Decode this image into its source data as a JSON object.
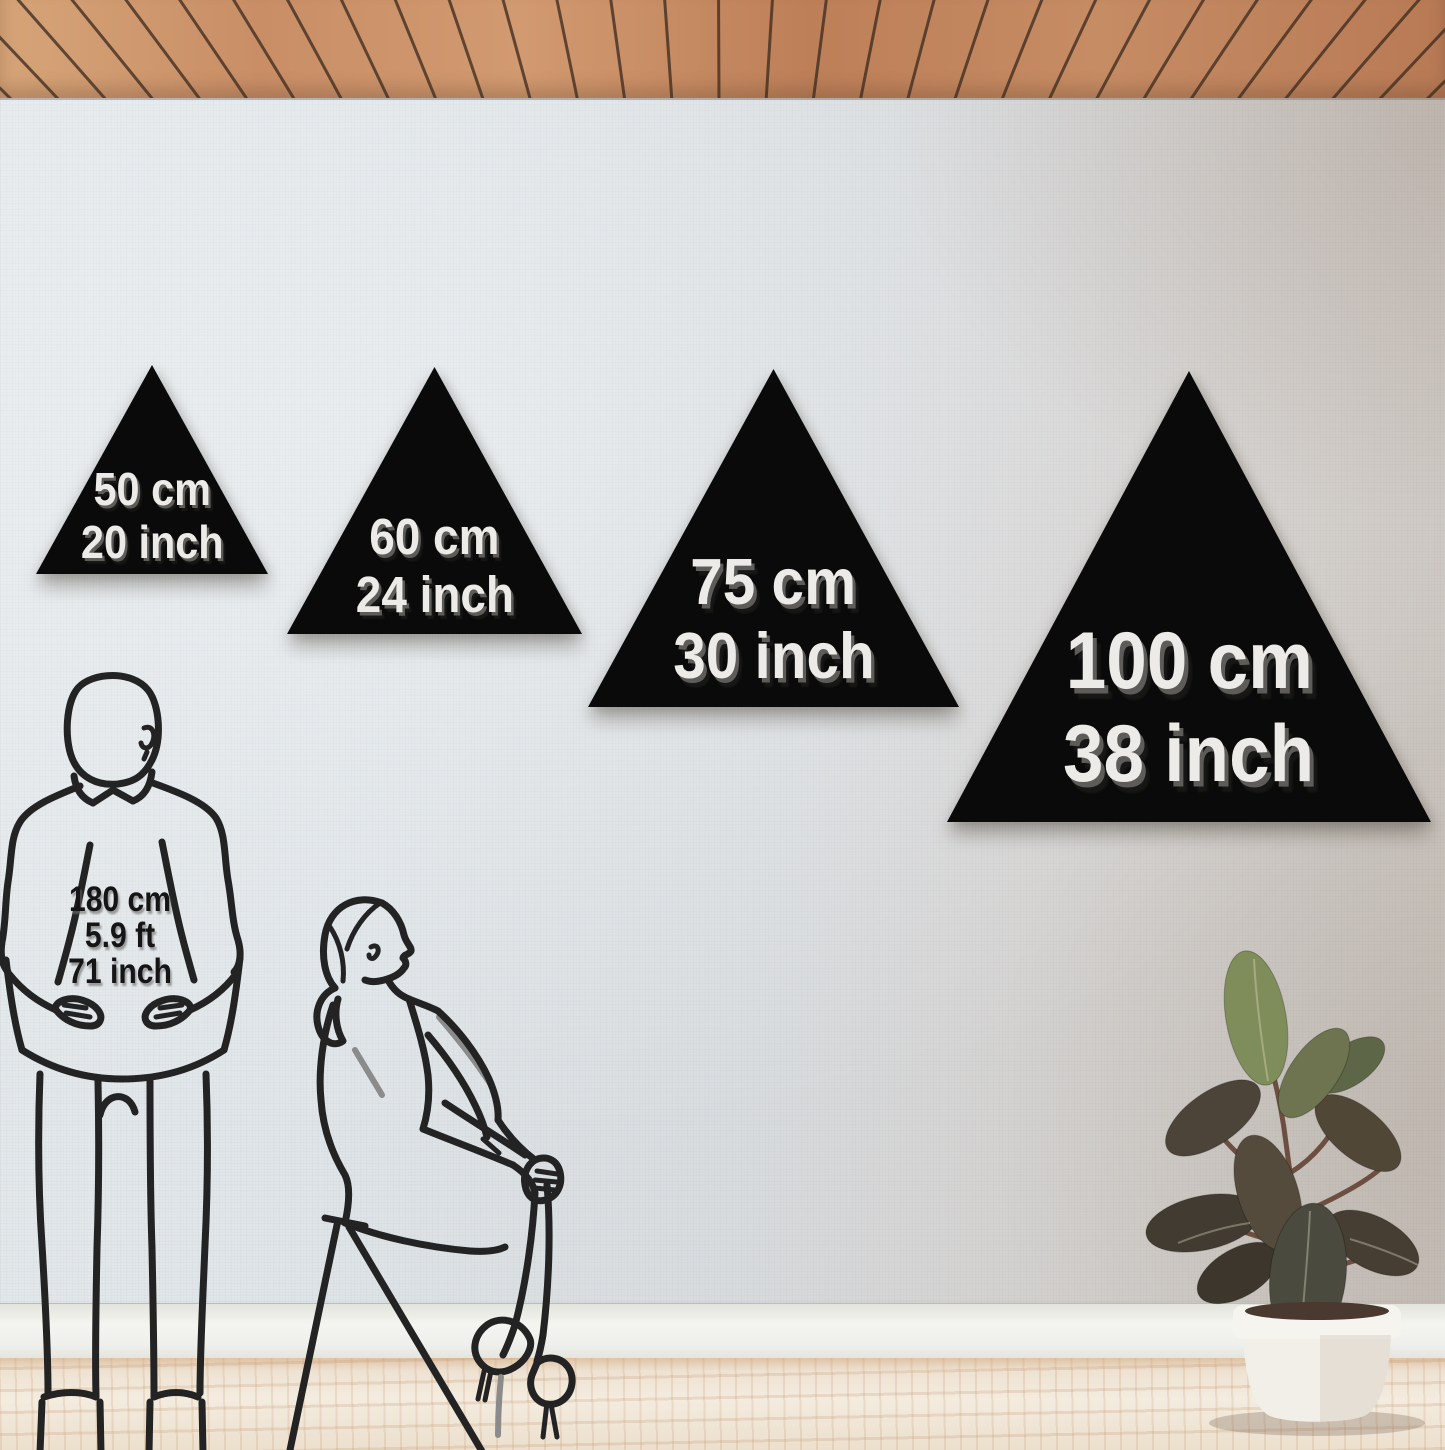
{
  "scene": {
    "type": "wall-decor-triangle-size-guide",
    "colors": {
      "triangle": "#0a0a0a",
      "triangle_label": "#ecebe7",
      "wall": "#dde2e4",
      "ceiling_wood": "#c98e66",
      "floor_wood": "#f0e7da",
      "figure_line": "#232323",
      "baseboard": "#f2f2ee"
    }
  },
  "triangles": [
    {
      "id": "size-50",
      "cm": "50 cm",
      "inch": "20 inch"
    },
    {
      "id": "size-60",
      "cm": "60 cm",
      "inch": "24 inch"
    },
    {
      "id": "size-75",
      "cm": "75 cm",
      "inch": "30 inch"
    },
    {
      "id": "size-100",
      "cm": "100 cm",
      "inch": "38 inch"
    }
  ],
  "reference_person": {
    "height_cm": "180 cm",
    "height_ft": "5.9 ft",
    "height_inch": "71 inch"
  }
}
